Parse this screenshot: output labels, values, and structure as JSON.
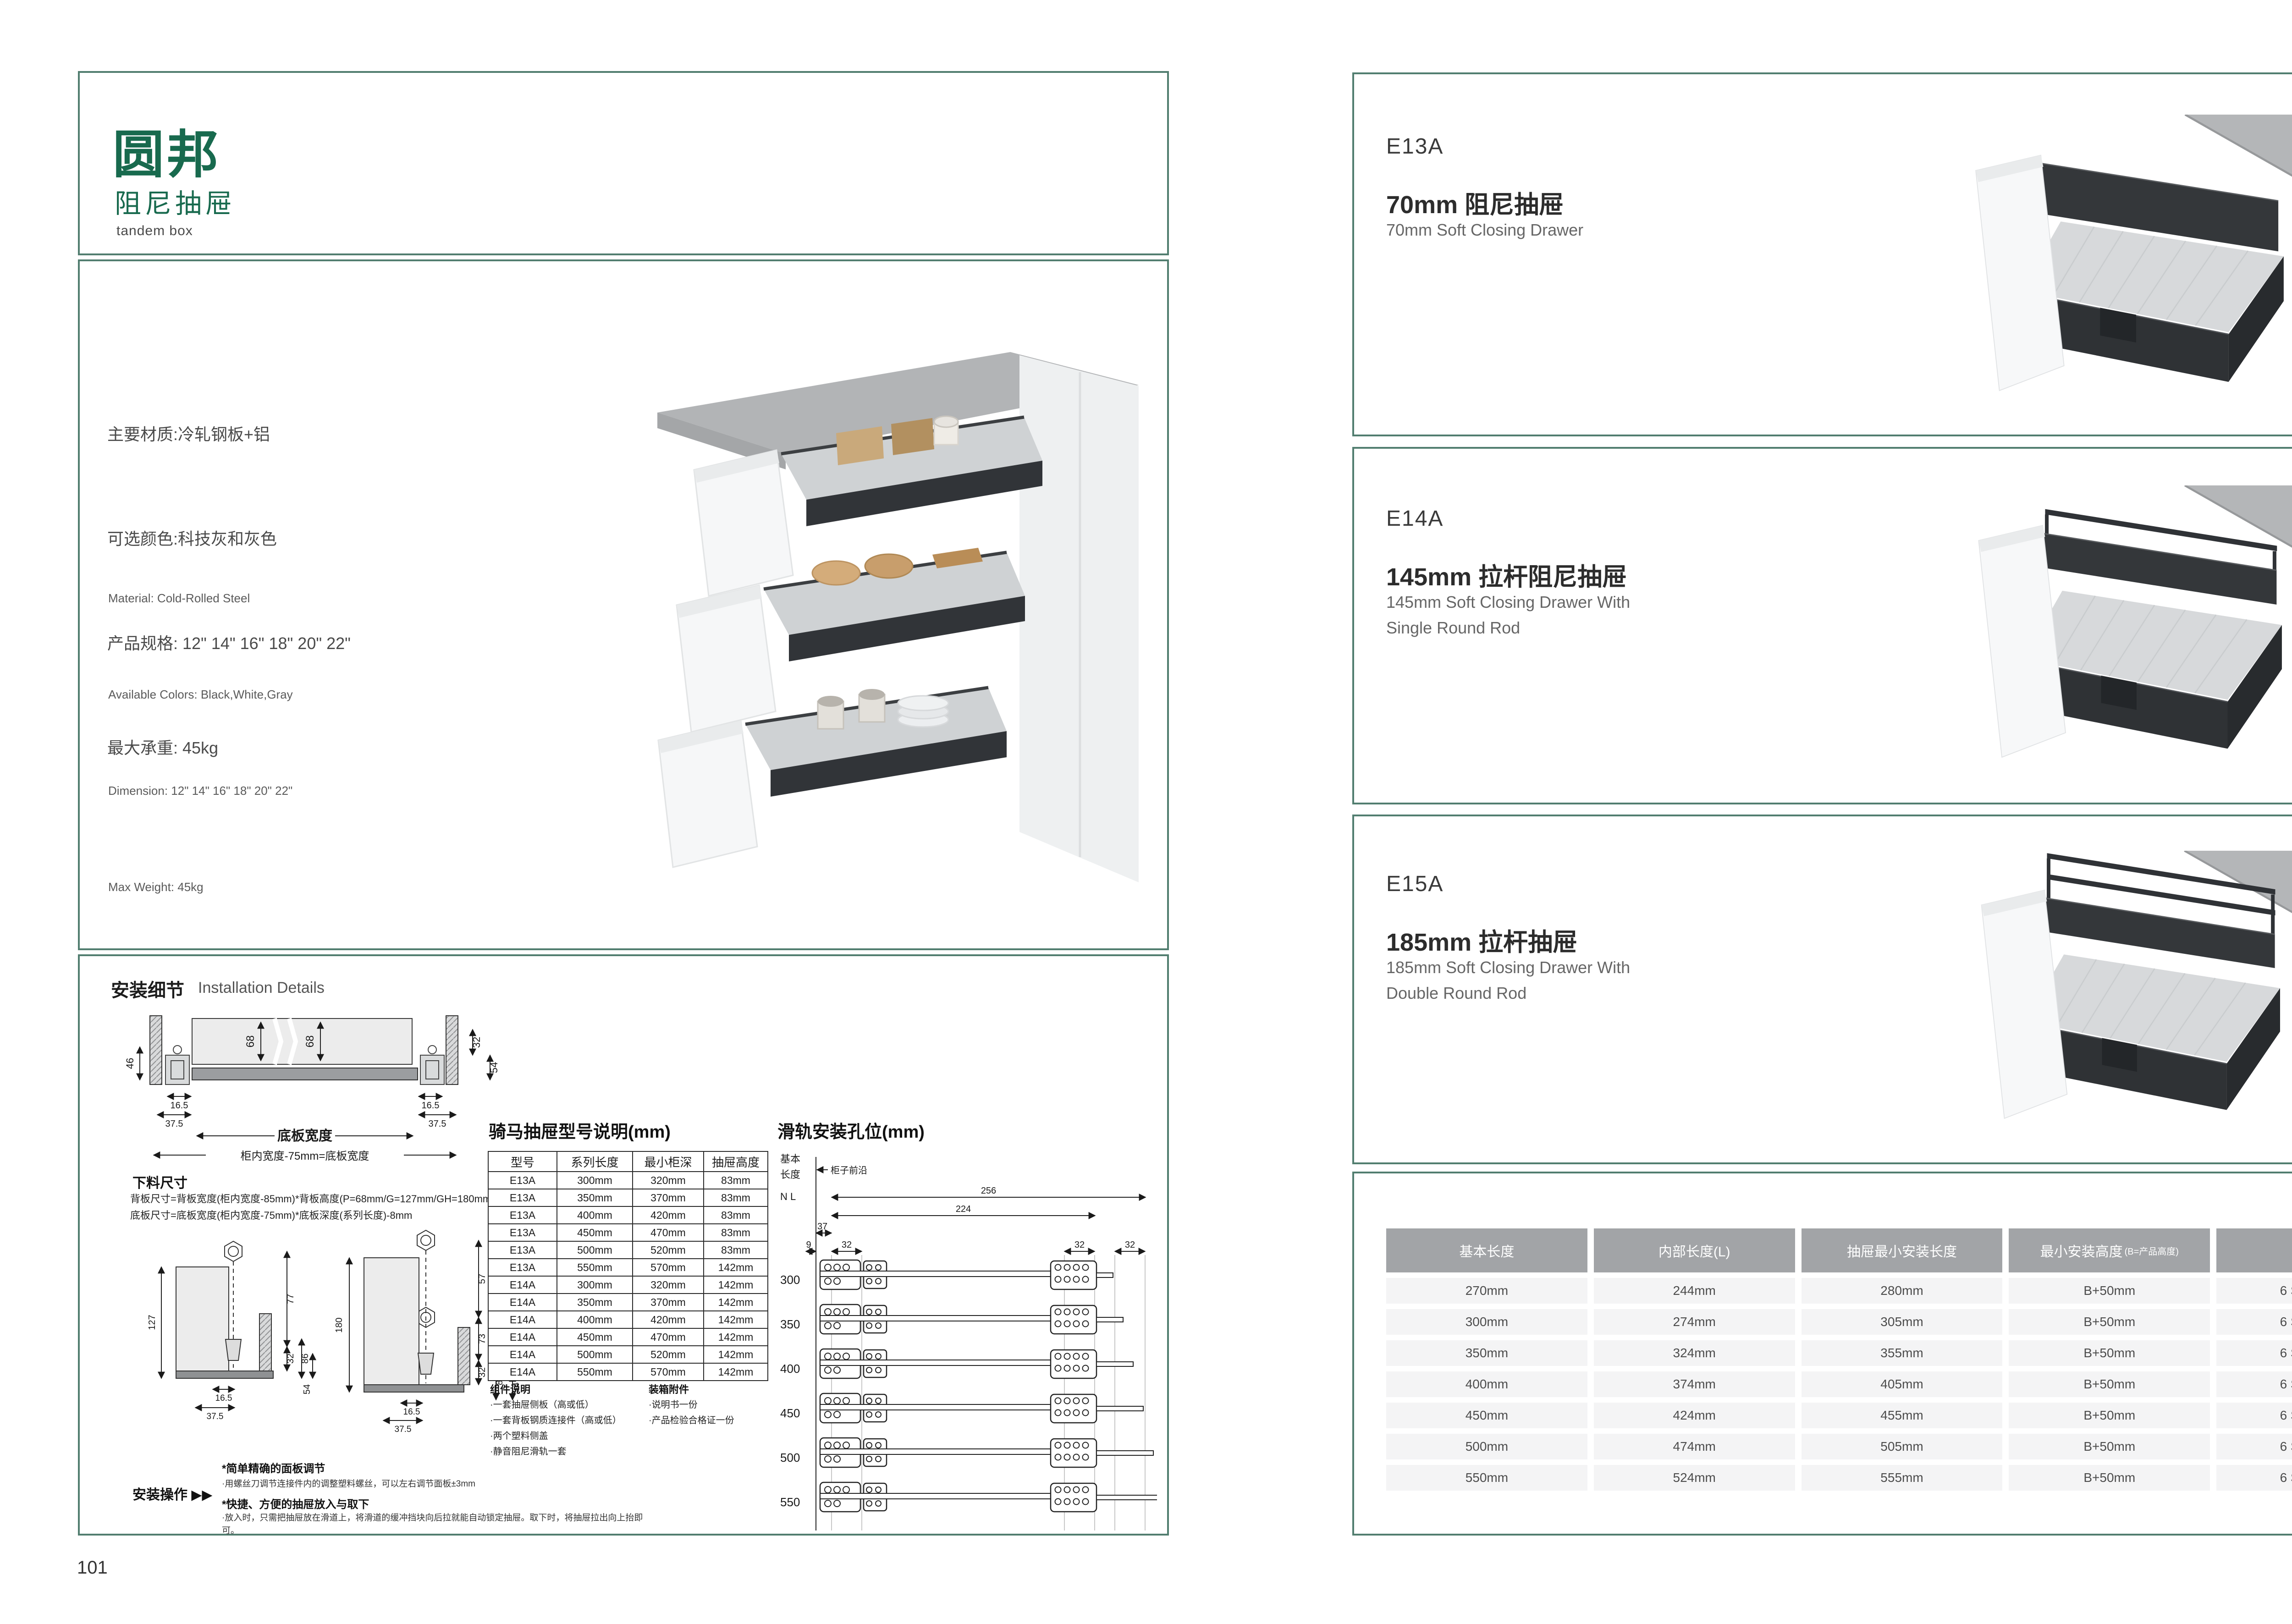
{
  "colors": {
    "accent_green": "#186a4e",
    "border_teal": "#527e70",
    "table_header_bg": "#a2a4a7",
    "table_row_bg": "#f4f4f5"
  },
  "left_page": {
    "page_number": "101",
    "logo": {
      "brand": "圆邦",
      "subtitle": "阻尼抽屉",
      "tagline": "tandem box"
    },
    "specs_cn": [
      "主要材质:冷轧钢板+铝",
      "可选颜色:科技灰和灰色",
      "产品规格: 12\" 14\" 16\" 18\" 20\" 22\"",
      "最大承重: 45kg"
    ],
    "specs_en": [
      "Material: Cold-Rolled Steel",
      "Available Colors: Black,White,Gray",
      "Dimension: 12\" 14\" 16\" 18\" 20\" 22\"",
      "Max Weight: 45kg"
    ],
    "install_details": {
      "title_cn": "安装细节",
      "title_en": "Installation Details"
    },
    "cross_section": {
      "d68a": "68",
      "d68b": "68",
      "d46": "46",
      "d32": "32",
      "d54": "54",
      "d165a": "16.5",
      "d375a": "37.5",
      "d165b": "16.5",
      "d375b": "37.5",
      "bottom_width_label": "底板宽度",
      "inner_width_formula": "柜内宽度-75mm=底板宽度"
    },
    "cutting": {
      "title": "下料尺寸",
      "line1": "背板尺寸=背板宽度(柜内宽度-85mm)*背板高度(P=68mm/G=127mm/GH=180mm)*16mm",
      "line2": "底板尺寸=底板宽度(柜内宽度-75mm)*底板深度(系列长度)-8mm"
    },
    "side1": {
      "d127": "127",
      "d77": "77",
      "d32": "32",
      "d86": "86",
      "d54": "54",
      "d165": "16.5",
      "d375": "37.5"
    },
    "side2": {
      "d180": "180",
      "d57": "57",
      "d73": "73",
      "d130": "130",
      "d32": "32",
      "d86": "86",
      "d54": "54",
      "d165": "16.5",
      "d375": "37.5"
    },
    "install_op": {
      "label": "安装操作",
      "arrows": "▶▶",
      "h1": "*简单精确的面板调节",
      "b1": "·用螺丝刀调节连接件内的调整塑料螺丝，可以左右调节面板±3mm",
      "h2": "*快捷、方便的抽屉放入与取下",
      "b2": "·放入时，只需把抽屉放在滑道上，将滑道的缓冲挡块向后拉就能自动锁定抽屉。取下时，将抽屉拉出向上抬即可。"
    },
    "model_table": {
      "title": "骑马抽屉型号说明(mm)",
      "headers": [
        "型号",
        "系列长度",
        "最小柜深",
        "抽屉高度"
      ],
      "rows": [
        [
          "E13A",
          "300mm",
          "320mm",
          "83mm"
        ],
        [
          "E13A",
          "350mm",
          "370mm",
          "83mm"
        ],
        [
          "E13A",
          "400mm",
          "420mm",
          "83mm"
        ],
        [
          "E13A",
          "450mm",
          "470mm",
          "83mm"
        ],
        [
          "E13A",
          "500mm",
          "520mm",
          "83mm"
        ],
        [
          "E13A",
          "550mm",
          "570mm",
          "142mm"
        ],
        [
          "E14A",
          "300mm",
          "320mm",
          "142mm"
        ],
        [
          "E14A",
          "350mm",
          "370mm",
          "142mm"
        ],
        [
          "E14A",
          "400mm",
          "420mm",
          "142mm"
        ],
        [
          "E14A",
          "450mm",
          "470mm",
          "142mm"
        ],
        [
          "E14A",
          "500mm",
          "520mm",
          "142mm"
        ],
        [
          "E14A",
          "550mm",
          "570mm",
          "142mm"
        ]
      ]
    },
    "components": {
      "title": "组件说明",
      "items": [
        "·一套抽屉侧板（高或低）",
        "·一套背板钢质连接件（高或低）",
        "·两个塑料侧盖",
        "·静音阻尼滑轨一套"
      ]
    },
    "accessories": {
      "title": "装箱附件",
      "items": [
        "·说明书一份",
        "·产品检验合格证一份"
      ]
    },
    "rail_holes": {
      "title": "滑轨安装孔位(mm)",
      "axis1": "基本",
      "axis2": "长度",
      "axis3": "N L",
      "front_label": "柜子前沿",
      "dims": [
        "256",
        "224",
        "37",
        "9",
        "32",
        "32",
        "32"
      ],
      "lengths": [
        "300",
        "350",
        "400",
        "450",
        "500",
        "550"
      ]
    }
  },
  "right_page": {
    "page_number": "102",
    "products": [
      {
        "model": "E13A",
        "title_cn": "70mm 阻尼抽屉",
        "title_en1": "70mm Soft Closing Drawer",
        "title_en2": ""
      },
      {
        "model": "E14A",
        "title_cn": "145mm 拉杆阻尼抽屉",
        "title_en1": "145mm Soft Closing Drawer With",
        "title_en2": "Single Round Rod"
      },
      {
        "model": "E15A",
        "title_cn": "185mm 拉杆抽屉",
        "title_en1": "185mm Soft Closing Drawer With",
        "title_en2": "Double Round Rod"
      }
    ],
    "size_table": {
      "headers": [
        {
          "main": "基本长度"
        },
        {
          "main": "内部长度(L)"
        },
        {
          "main": "抽屉最小安装长度"
        },
        {
          "main": "最小安装高度",
          "small": "(B=产品高度)"
        },
        {
          "main": "包装"
        }
      ],
      "rows": [
        [
          "270mm",
          "244mm",
          "280mm",
          "B+50mm",
          "6 SETC/TNB"
        ],
        [
          "300mm",
          "274mm",
          "305mm",
          "B+50mm",
          "6 SETC/TNB"
        ],
        [
          "350mm",
          "324mm",
          "355mm",
          "B+50mm",
          "6 SETC/TNB"
        ],
        [
          "400mm",
          "374mm",
          "405mm",
          "B+50mm",
          "6 SETC/TNB"
        ],
        [
          "450mm",
          "424mm",
          "455mm",
          "B+50mm",
          "6 SETC/TNB"
        ],
        [
          "500mm",
          "474mm",
          "505mm",
          "B+50mm",
          "6 SETC/TNB"
        ],
        [
          "550mm",
          "524mm",
          "555mm",
          "B+50mm",
          "6 SETC/TNB"
        ]
      ]
    }
  }
}
